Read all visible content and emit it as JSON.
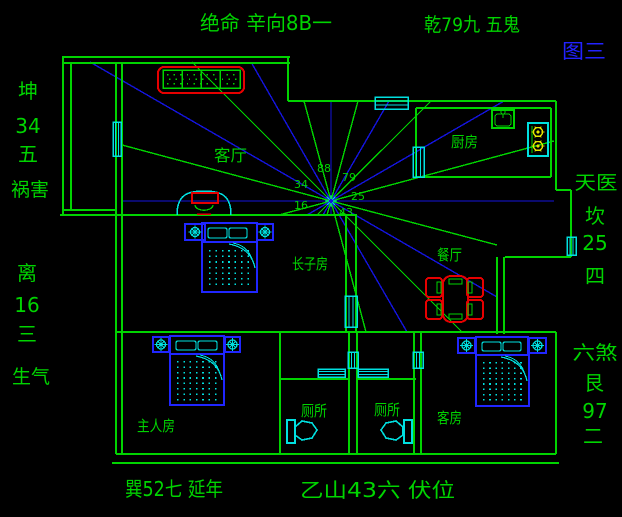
{
  "figure_tag": "图三",
  "outer": {
    "top_left": "绝命 辛向8B一",
    "top_right": "乾79九 五鬼",
    "bottom_left": "巽52七 延年",
    "bottom_right": "乙山43六 伏位",
    "left_upper": [
      "坤",
      "34",
      "五",
      "祸害"
    ],
    "left_lower": [
      "离",
      "16",
      "三",
      "生气"
    ],
    "right_upper": [
      "天医",
      "坎",
      "25",
      "四"
    ],
    "right_lower": [
      "六煞",
      "艮",
      "97",
      "二"
    ]
  },
  "rooms": {
    "living_room": "客厅",
    "kitchen": "厨房",
    "dining_room": "餐厅",
    "eldest_son_room": "长子房",
    "master_room": "主人房",
    "toilet_left": "厕所",
    "toilet_right": "厕所",
    "guest_room": "客房"
  },
  "compass": {
    "n": "88",
    "ne": "79",
    "e": "25",
    "w": "34",
    "wsw": "16",
    "s": "43"
  },
  "colors": {
    "background": "#000000",
    "wall_green": "#00d400",
    "ray_blue": "#1414dd",
    "furniture_blue": "#2026ff",
    "cyan": "#00e0e0",
    "red": "#e60000",
    "yellow": "#e6e600",
    "label_blue": "#2222ff"
  }
}
